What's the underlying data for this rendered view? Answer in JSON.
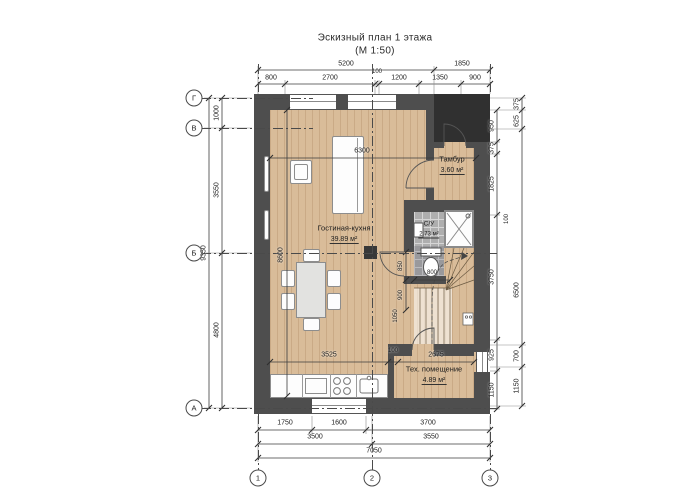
{
  "title": {
    "line1": "Эскизный план 1 этажа",
    "line2": "(М 1:50)"
  },
  "axes": {
    "left": [
      "Г",
      "В",
      "Б",
      "А"
    ],
    "bottom": [
      "1",
      "2",
      "3"
    ]
  },
  "rooms": {
    "living": {
      "name": "Гостиная-кухня",
      "area": "39.89 м²"
    },
    "tambour": {
      "name": "Тамбур",
      "area": "3.60 м²"
    },
    "wc": {
      "name": "С/У",
      "area": "2.73 м²"
    },
    "tech": {
      "name": "Тех. помещение",
      "area": "4.89 м²"
    }
  },
  "dims": {
    "top1": [
      "5200",
      "1850"
    ],
    "top2": [
      "800",
      "2700",
      "100",
      "1200",
      "1350",
      "900"
    ],
    "left": {
      "total": "9350",
      "segments": [
        "1000",
        "3550",
        "4800"
      ]
    },
    "right_inner": [
      "950",
      "375",
      "1825",
      "3750",
      "925",
      "1150"
    ],
    "right_inner_extra": "100",
    "right_outer": [
      "375",
      "625",
      "6500",
      "700",
      "1150"
    ],
    "bottom1": [
      "1750",
      "1600",
      "3700"
    ],
    "bottom2": [
      "3500",
      "3550"
    ],
    "bottom3": [
      "7050"
    ],
    "interior": {
      "width": "6300",
      "height": "8600",
      "kitchen": "3525",
      "wall": "100",
      "tech": "2675"
    },
    "stairs": [
      "800",
      "850",
      "900",
      "1050"
    ]
  },
  "colors": {
    "wood": "#d9bc99",
    "wall": "#4e4e4e",
    "porch": "#303030",
    "tile": "#aeaeae",
    "line": "#3c3c3c"
  }
}
